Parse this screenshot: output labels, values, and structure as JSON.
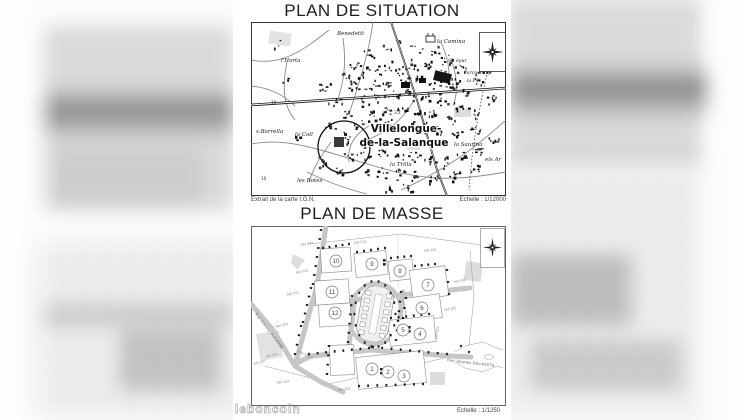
{
  "watermark": "leboncoin",
  "situation": {
    "title": "PLAN DE SITUATION",
    "source_note": "Extrait de la carte I.G.N.",
    "scale_note": "Echelle : 1/12000",
    "town_line1": "Villelongue-",
    "town_line2": "de-la-Salanque",
    "labels": {
      "benedetti": "Benedetti",
      "horta": "l'Horta",
      "comina": "la Comina",
      "st_epur": "St. épur",
      "parcours": "Parcours sp",
      "pile": "la Pile",
      "barrella": "s.Barrella",
      "coll": "la Coll",
      "rotes": "les Rotes",
      "saurina": "la Saurina",
      "trilla": "la Trilla",
      "els_ar": "els Ar",
      "spot_height": "3,2",
      "spot_10a": "10",
      "spot_10b": "10"
    }
  },
  "masse": {
    "title": "PLAN DE MASSE",
    "scale_note": "Echelle : 1/1250",
    "lots": [
      "1",
      "2",
      "3",
      "4",
      "5",
      "6",
      "7",
      "8",
      "9",
      "10",
      "11",
      "12"
    ],
    "parcels": [
      "AM 344",
      "AM 515",
      "AM 335",
      "AM 343",
      "AM 432",
      "AM 342",
      "AM 325",
      "AM 309",
      "AM 303",
      "AM 307",
      "AM 234",
      "AM 253",
      "AM 334"
    ],
    "streets": {
      "ducasse": "Rue Etienne DUCASSE",
      "delhoste": "Rue Jacques DELHOSTE"
    },
    "area_label": "Macabeu"
  }
}
